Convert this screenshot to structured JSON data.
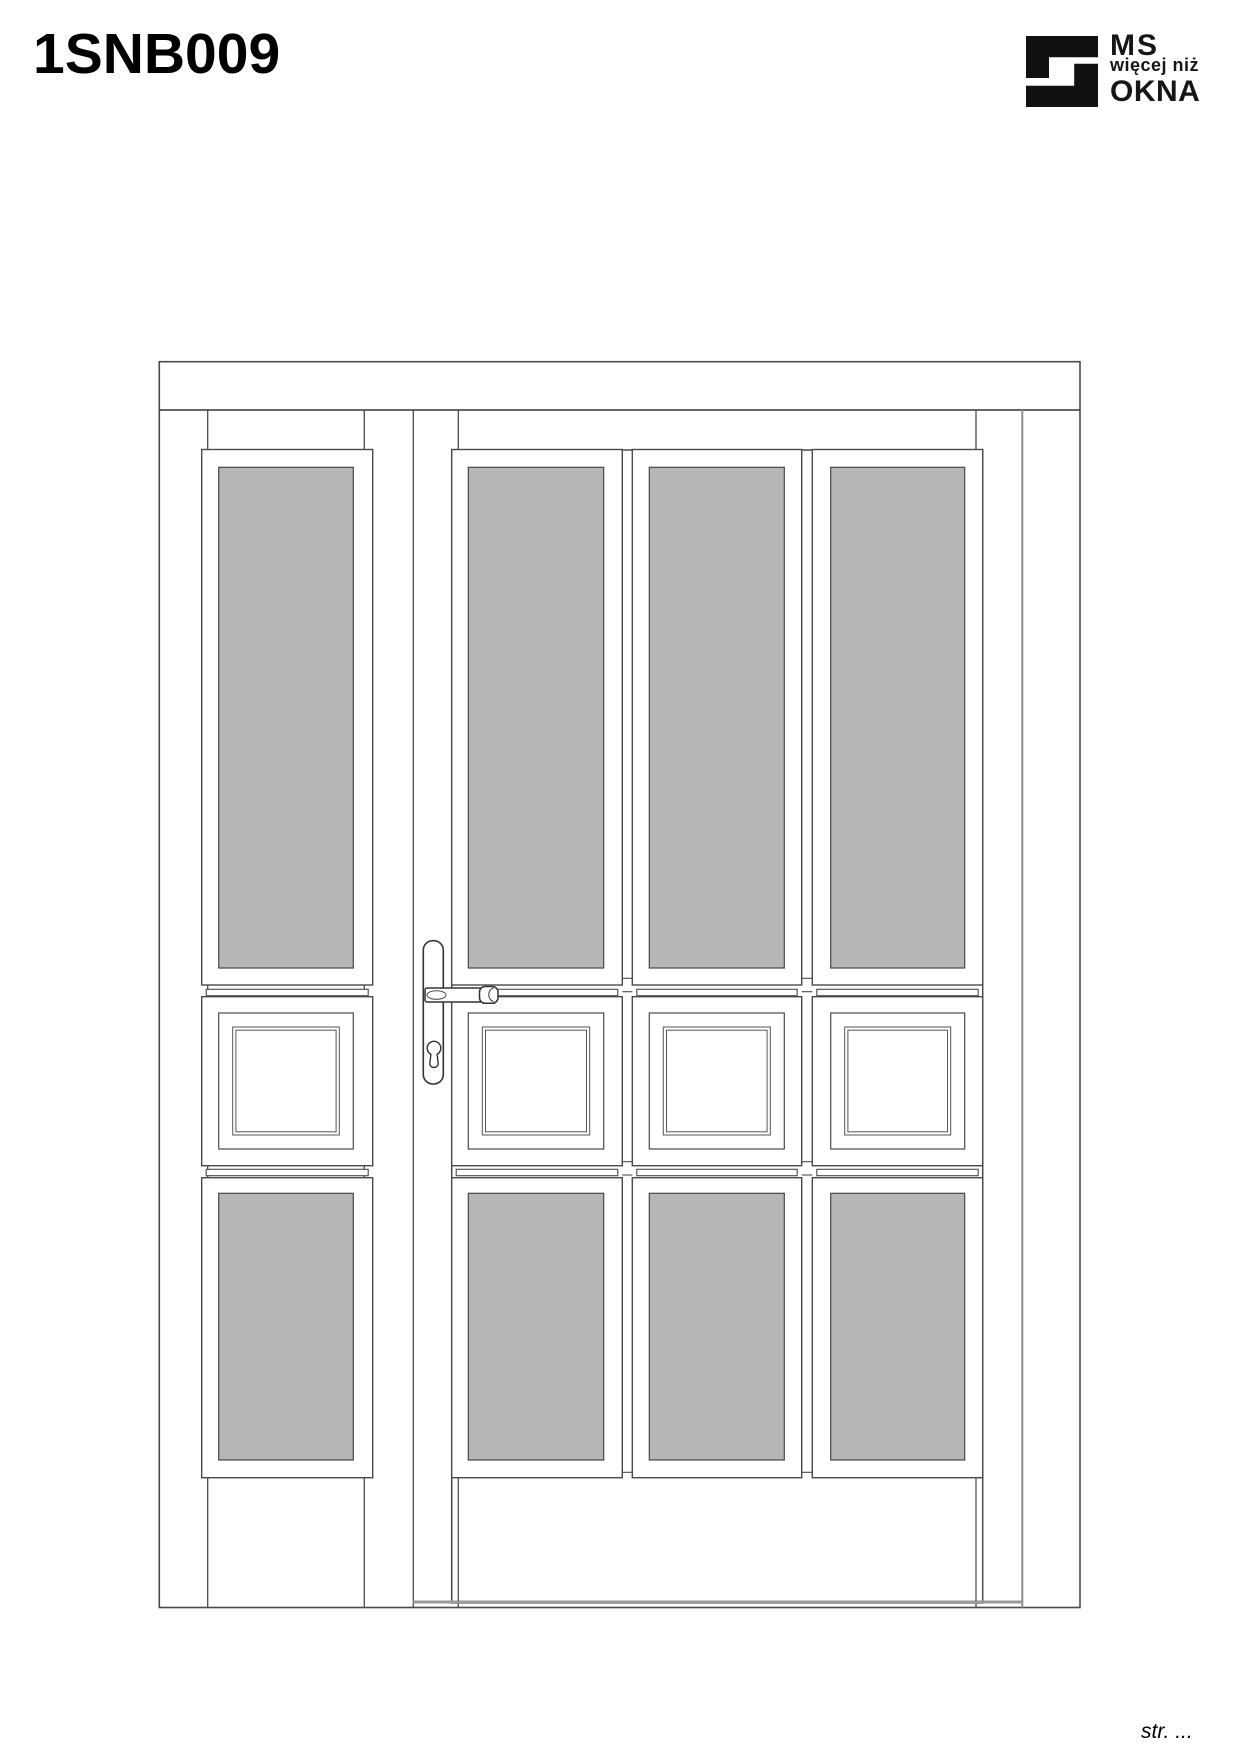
{
  "header": {
    "model_code": "1SNB009"
  },
  "logo": {
    "line1": "MS",
    "line2": "więcej niż",
    "line3": "OKNA"
  },
  "footer": {
    "page_label": "str. ..."
  },
  "drawing": {
    "description": "Front elevation of an entry door with three glazed columns and a left sidelight; each column has a tall upper glazing, a square raised panel and a lower glazing; lever handle with cylinder keyhole on backplate",
    "sidelight_columns": 1,
    "door_columns": 3,
    "colors": {
      "background": "#ffffff",
      "glass": "#b6b6b6",
      "line": "#4a4a4a",
      "line_dark": "#333333",
      "line_light": "#8f8f8f",
      "threshold": "#9a9a9a"
    }
  }
}
